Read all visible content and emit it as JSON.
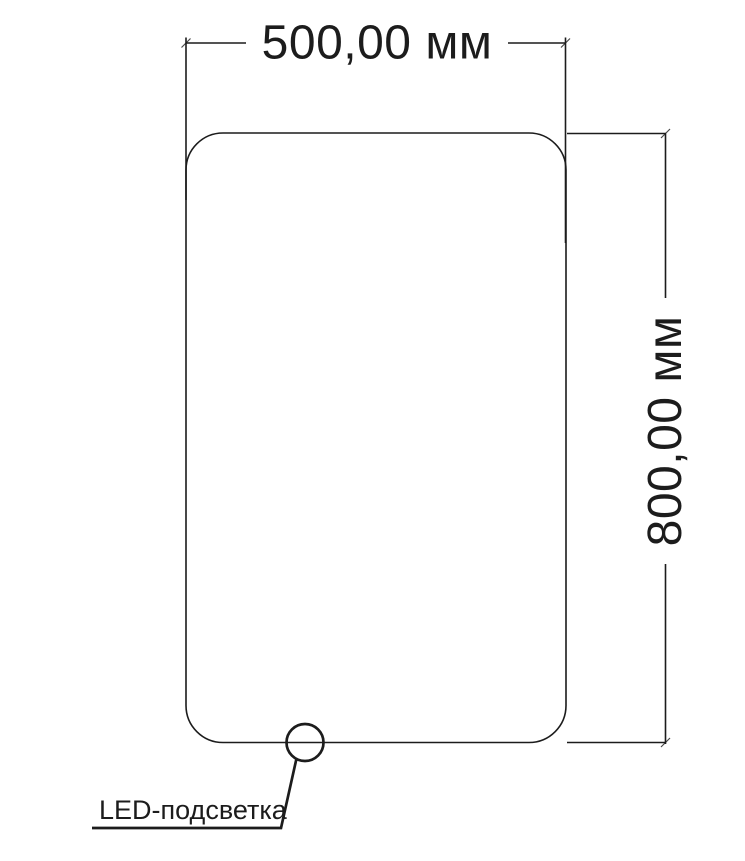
{
  "drawing": {
    "title": "mirror-dimension-drawing",
    "background_color": "#ffffff",
    "line_color": "#1c1c1c",
    "dimensions": {
      "width_label": "500,00 мм",
      "height_label": "800,00 мм"
    },
    "callout": {
      "led_label": "LED-подсветка"
    }
  }
}
